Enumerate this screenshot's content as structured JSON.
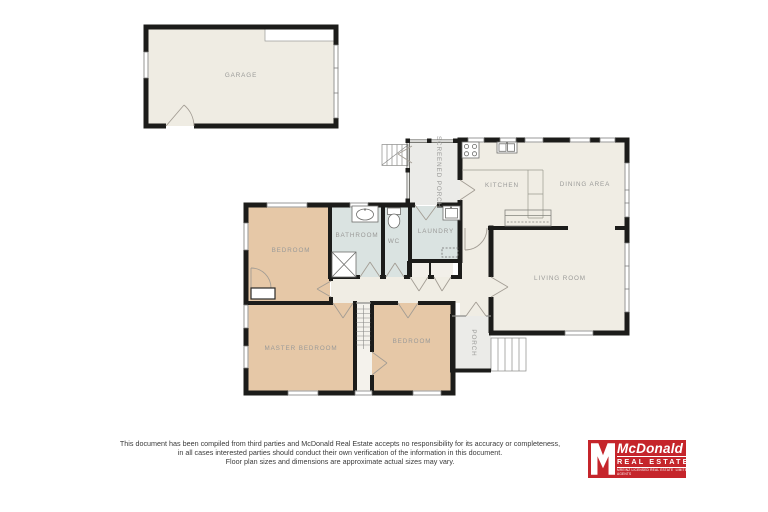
{
  "floor_plan": {
    "rooms": {
      "garage": "GARAGE",
      "screened_porch": "SCREENED PORCH",
      "kitchen": "KITCHEN",
      "dining_area": "DINING AREA",
      "bedroom_top": "BEDROOM",
      "bathroom": "BATHROOM",
      "wc": "WC",
      "laundry": "LAUNDRY",
      "living_room": "LIVING ROOM",
      "master_bedroom": "MASTER BEDROOM",
      "bedroom_bottom": "BEDROOM",
      "porch": "PORCH"
    },
    "colors": {
      "room_fill": "#f0ede4",
      "bedroom_fill": "#e6c8a7",
      "wet_area_fill": "#dae3e1",
      "porch_fill": "#ebebe8",
      "wall": "#1c1c1a",
      "label": "#9a9a98"
    }
  },
  "disclaimer": {
    "line1": "This document has been compiled from third parties and McDonald Real Estate accepts no responsibility for its accuracy or completeness,",
    "line2": "in all cases interested parties should conduct their own verification of the information in this document.",
    "line3": "Floor plan sizes and dimensions are approximate actual sizes may vary."
  },
  "logo": {
    "brand": "McDonald",
    "tagline": "REAL ESTATE",
    "fine_print_left": "MREINZ  LICENSED REAL ESTATE AGENTS",
    "fine_print_right": "LIMITED",
    "background": "#c5252b"
  }
}
